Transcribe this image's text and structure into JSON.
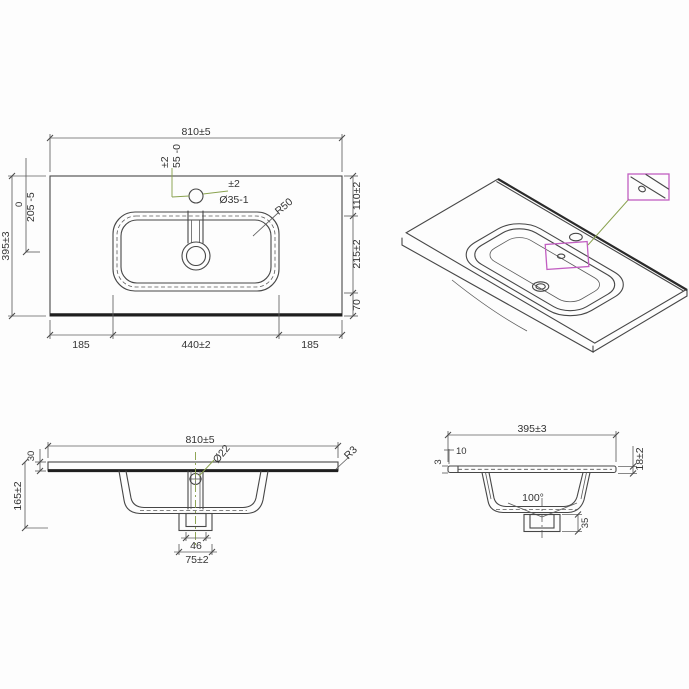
{
  "meta": {
    "drawing_type": "washbasin technical drawing",
    "background": "#fdfdfd",
    "line_color": "#474747",
    "accent_green": "#8aa24f",
    "accent_magenta": "#c25fc2"
  },
  "plan": {
    "width": "810±5",
    "faucet_offset_tol": "±2",
    "faucet_offset": "55 -0",
    "hole_tol": "±2",
    "hole_dia": "Ø35-1",
    "corner_radius": "R50",
    "height": "395±3",
    "basin_ref_zero": "0",
    "basin_position": "205 -5",
    "right_top": "110±2",
    "right_mid": "215±2",
    "right_bottom": "70",
    "bottom_left": "185",
    "bottom_center": "440±2",
    "bottom_right": "185"
  },
  "front": {
    "width": "810±5",
    "overflow_dia": "Ø22",
    "slab_thickness": "30",
    "total_depth": "165±2",
    "edge_radius": "R3",
    "drain_inner_width": "46",
    "drain_outer_width": "75±2"
  },
  "side": {
    "depth": "395±3",
    "back_ledge": "10",
    "front_lip": "3",
    "edge_thickness": "18±2",
    "basin_angle": "100°",
    "drain_height": "35"
  }
}
